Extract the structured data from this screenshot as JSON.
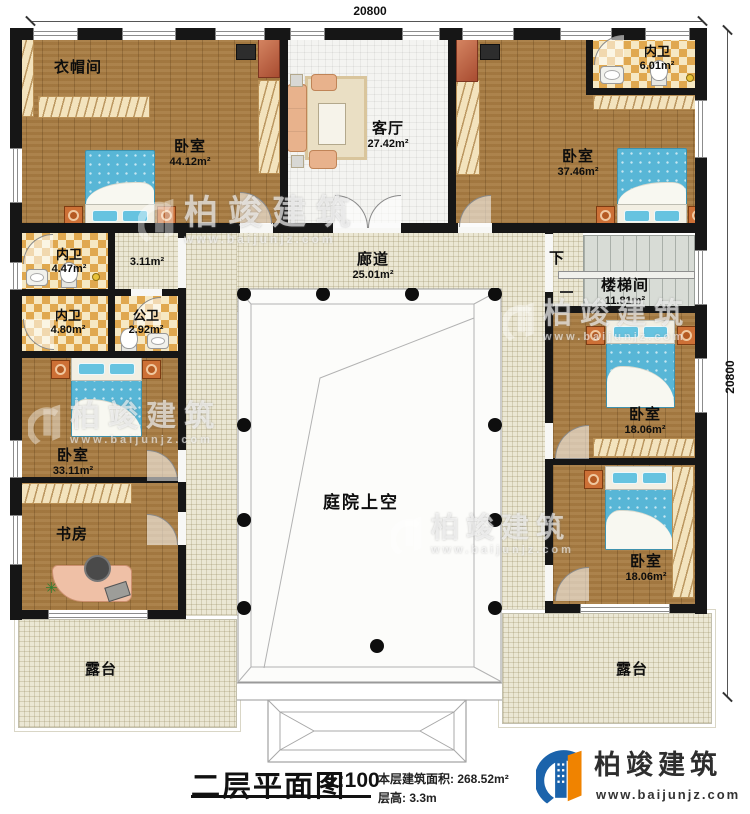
{
  "dimensions": {
    "top": "20800",
    "right": "20800"
  },
  "rooms": {
    "cloakroom": {
      "name": "衣帽间"
    },
    "master_bedroom": {
      "name": "卧室",
      "area": "44.12m²"
    },
    "living_room": {
      "name": "客厅",
      "area": "27.42m²"
    },
    "ensuite_top_right": {
      "name": "内卫",
      "area": "6.01m²"
    },
    "bedroom_top_right": {
      "name": "卧室",
      "area": "37.46m²"
    },
    "ensuite_447": {
      "name": "内卫",
      "area": "4.47m²"
    },
    "hallway_311": {
      "area": "3.11m²"
    },
    "ensuite_480": {
      "name": "内卫",
      "area": "4.80m²"
    },
    "public_bath": {
      "name": "公卫",
      "area": "2.92m²"
    },
    "corridor": {
      "name": "廊道",
      "area": "25.01m²"
    },
    "stairs_down": {
      "label": "下"
    },
    "stairwell": {
      "name": "楼梯间",
      "area": "11.81m²"
    },
    "bedroom_mid_left": {
      "name": "卧室",
      "area": "33.11m²"
    },
    "study": {
      "name": "书房"
    },
    "bedroom_right_1": {
      "name": "卧室",
      "area": "18.06m²"
    },
    "bedroom_right_2": {
      "name": "卧室",
      "area": "18.06m²"
    },
    "courtyard": {
      "name": "庭院上空"
    },
    "terrace_left": {
      "name": "露台"
    },
    "terrace_right": {
      "name": "露台"
    }
  },
  "title_block": {
    "title": "二层平面图",
    "scale": "1:100",
    "area_line": "本层建筑面积: 268.52m²",
    "height_line": "层高: 3.3m"
  },
  "brand": {
    "name": "柏竣建筑",
    "website": "www.baijunjz.com"
  },
  "watermark": {
    "name": "柏竣建筑",
    "website": "www.baijunjz.com"
  },
  "colors": {
    "wall": "#161616",
    "wood_floor": "#a87c42",
    "tile_floor": "#f4f4f1",
    "bath_checker": "#e0a84f",
    "paving": "#ebe7d4",
    "bed_blue": "#58b6d6",
    "sofa_salmon": "#e8b28c",
    "logo_blue": "#1b63ab",
    "logo_orange": "#f08300"
  }
}
